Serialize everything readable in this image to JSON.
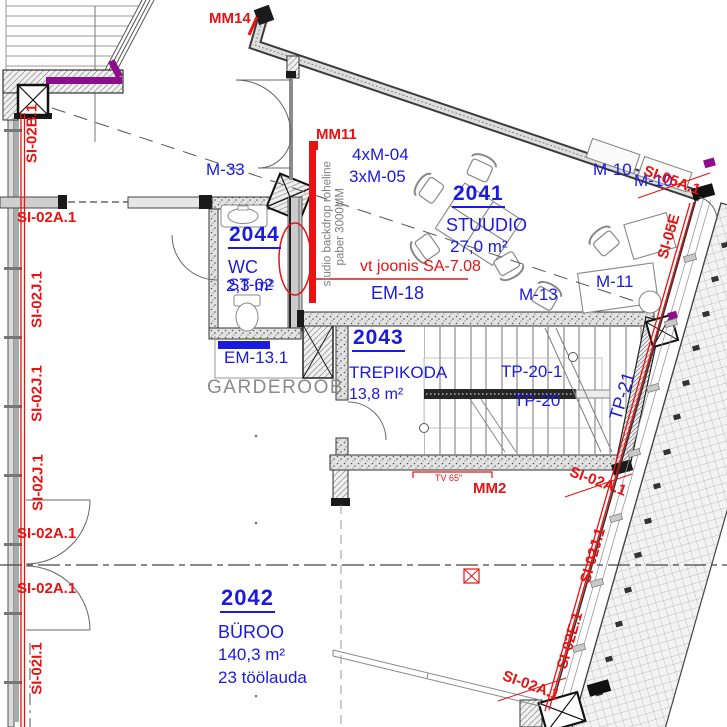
{
  "rooms": [
    {
      "number": "2041",
      "name": "STUUDIO",
      "area": "27,0 m²"
    },
    {
      "number": "2042",
      "name": "BÜROO",
      "area": "140,3 m²",
      "note": "23 töölauda"
    },
    {
      "number": "2043",
      "name": "TREPIKODA",
      "area": "13,8 m²"
    },
    {
      "number": "2044",
      "name": "WC",
      "area": "2,3 m²"
    }
  ],
  "element_codes": {
    "si02a1": "SI-02A.1",
    "si02b1": "SI-02B.1",
    "si02e1": "SI-02E.1",
    "si02i1": "SI-02I.1",
    "si02j1": "SI-02J.1",
    "si05a1": "SI-05A.1",
    "si05e": "SI-05E"
  },
  "markers": {
    "mm2": "MM2",
    "mm11": "MM11",
    "mm14": "MM14",
    "tv_size": "TV 65\""
  },
  "equipment": {
    "m33": "M-33",
    "m04_count": "4xM-04",
    "m05_count": "3xM-05",
    "m10": "M-10",
    "m11": "M-11",
    "m13": "M-13",
    "em18": "EM-18",
    "em131": "EM-13.1",
    "st02": "ST-02",
    "tp20": "TP-20",
    "tp201": "TP-20-1",
    "tp21": "TP-21"
  },
  "notes": {
    "drawing_ref": "vt joonis SA-7.08",
    "garderoob": "GARDEROOB",
    "backdrop_line1": "studio backdrop roheline",
    "backdrop_line2": "paber 3000MM"
  },
  "colors": {
    "label_blue": "#1a1ae0",
    "annotation_red": "#e81212",
    "note_gray": "#8a8a8a",
    "insulation_purple": "#8d0d8d"
  }
}
